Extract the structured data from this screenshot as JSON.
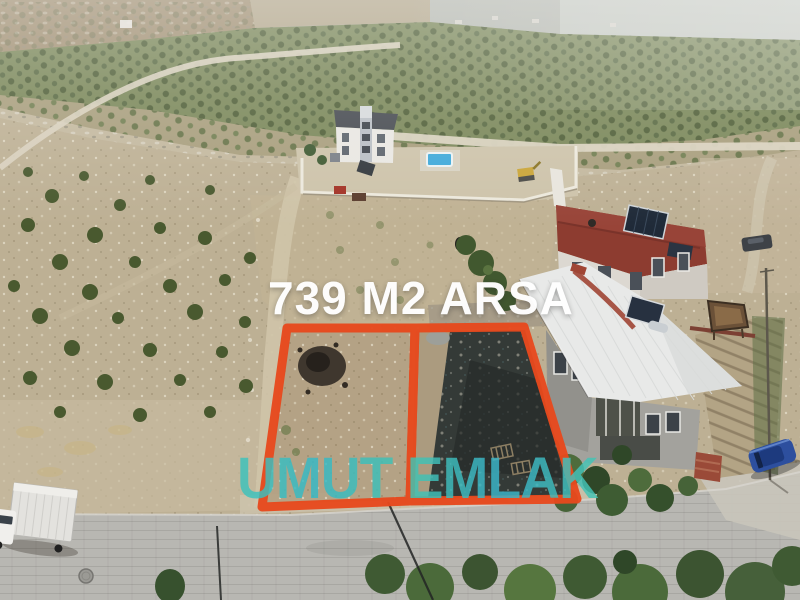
{
  "overlay": {
    "plot_size_label": "739 M2 ARSA",
    "agency_label": "UMUT EMLAK"
  },
  "colors": {
    "plot_outline": "#e7491d",
    "plot_size_text": "#ffffff",
    "agency_text_teal": "#41c3b8",
    "agency_text_blue": "#3ab4cc"
  }
}
